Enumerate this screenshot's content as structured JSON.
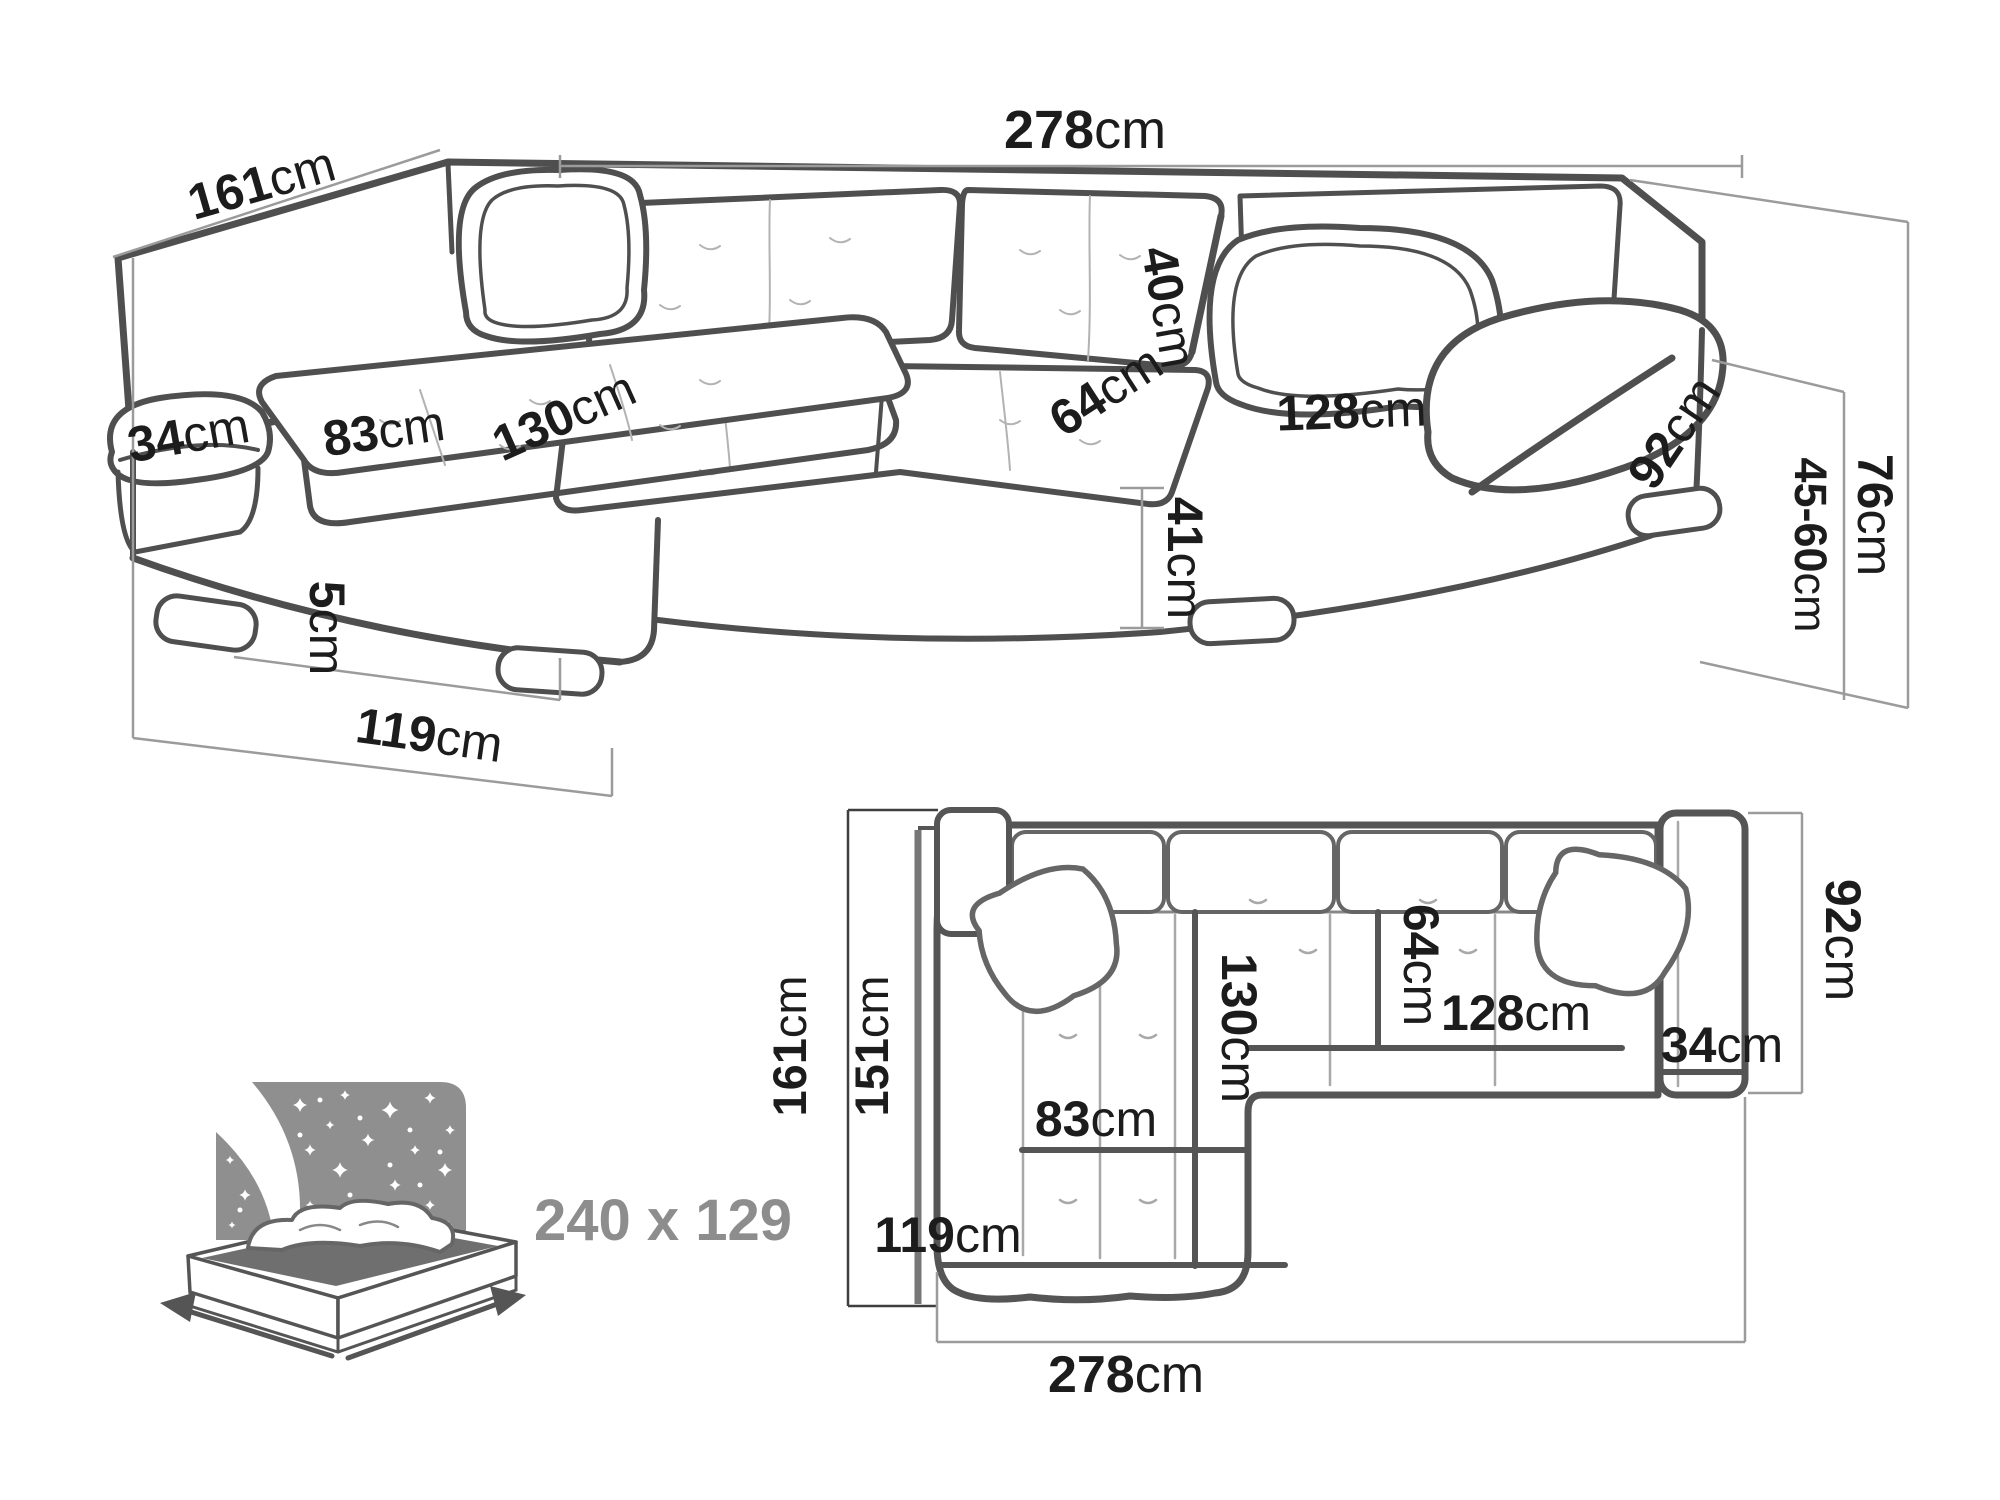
{
  "figure_type": "corner-sofa-dimensions-diagram",
  "colors": {
    "background": "#ffffff",
    "line_art": "#4f4f4f",
    "plan_lines": "#555555",
    "thin_guides": "#9b9b9b",
    "label_text": "#1c1c1c",
    "muted_gray": "#8d8d8d",
    "bed_panel_gray": "#8f8f8f",
    "mattress_gray": "#6f6f6f"
  },
  "labels_3d": {
    "depth_left": {
      "num": "161",
      "unit": "cm"
    },
    "width_total": {
      "num": "278",
      "unit": "cm"
    },
    "backrest_height": {
      "num": "40",
      "unit": "cm"
    },
    "seat_depth": {
      "num": "64",
      "unit": "cm"
    },
    "seat_width_right": {
      "num": "128",
      "unit": "cm"
    },
    "armrest_left": {
      "num": "34",
      "unit": "cm"
    },
    "chaise_seat_width": {
      "num": "83",
      "unit": "cm"
    },
    "chaise_length": {
      "num": "130",
      "unit": "cm"
    },
    "armrest_depth": {
      "num": "92",
      "unit": "cm"
    },
    "seat_height": {
      "num": "41",
      "unit": "cm"
    },
    "leg_height": {
      "num": "5",
      "unit": "cm"
    },
    "chaise_front": {
      "num": "119",
      "unit": "cm"
    },
    "total_height": {
      "num": "76",
      "unit": "cm"
    },
    "height_range": {
      "num": "45-60",
      "unit": "cm"
    }
  },
  "labels_plan": {
    "depth_left": {
      "num": "161",
      "unit": "cm"
    },
    "depth_inner": {
      "num": "151",
      "unit": "cm"
    },
    "chaise_length": {
      "num": "130",
      "unit": "cm"
    },
    "seat_depth": {
      "num": "64",
      "unit": "cm"
    },
    "seat_width_right": {
      "num": "128",
      "unit": "cm"
    },
    "armrest_width": {
      "num": "34",
      "unit": "cm"
    },
    "armrest_depth": {
      "num": "92",
      "unit": "cm"
    },
    "chaise_seat_width": {
      "num": "83",
      "unit": "cm"
    },
    "chaise_front": {
      "num": "119",
      "unit": "cm"
    },
    "width_total": {
      "num": "278",
      "unit": "cm"
    }
  },
  "sleeping_area": {
    "label": "240 x 129"
  }
}
